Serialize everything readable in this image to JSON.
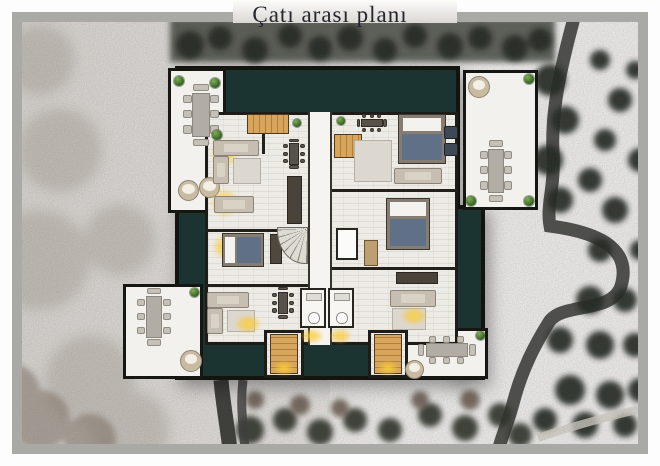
{
  "title": "Çatı arası planı",
  "colors": {
    "frame": "#a9a9a5",
    "wall": "#14140f",
    "roof": "#1b3331",
    "terrace": "#f2f1ed",
    "floor": "#edebe5",
    "hall": "#f5f4f0",
    "wood": "#d7a55c",
    "wood_dark": "#b07f3f",
    "glow": "#f6cf3a",
    "blanket": "#5f7087",
    "sofa": "#c6bfb1",
    "table_gray": "#b2ada4",
    "chair_gray": "#c6c1b8",
    "table_dark": "#57534b",
    "plant": "#3e6b2a",
    "road": "#3c3c3a",
    "snow": "#f2f1ef",
    "trees": "#22261f"
  },
  "plan": {
    "regions": [
      {
        "name": "roof-main",
        "type": "roof",
        "x": 175,
        "y": 66,
        "w": 285,
        "h": 314
      },
      {
        "name": "roof-right-wing",
        "type": "roof",
        "x": 452,
        "y": 205,
        "w": 33,
        "h": 175
      },
      {
        "name": "terrace-top-left",
        "type": "terrace",
        "x": 168,
        "y": 68,
        "w": 58,
        "h": 145
      },
      {
        "name": "terrace-top-right",
        "type": "terrace",
        "x": 463,
        "y": 70,
        "w": 75,
        "h": 140
      },
      {
        "name": "terrace-bottom-left",
        "type": "terrace",
        "x": 123,
        "y": 284,
        "w": 80,
        "h": 95
      },
      {
        "name": "terrace-bottom-right",
        "type": "terrace",
        "x": 403,
        "y": 328,
        "w": 85,
        "h": 51
      },
      {
        "name": "apartments-interior",
        "type": "floor",
        "x": 205,
        "y": 112,
        "w": 253,
        "h": 233
      },
      {
        "name": "stairwell-south-left",
        "type": "floor",
        "x": 264,
        "y": 330,
        "w": 40,
        "h": 48
      },
      {
        "name": "stairwell-south-right",
        "type": "floor",
        "x": 368,
        "y": 330,
        "w": 40,
        "h": 48
      },
      {
        "name": "central-corridor",
        "type": "hall",
        "x": 308,
        "y": 112,
        "w": 24,
        "h": 233
      },
      {
        "name": "elevator",
        "type": "lift",
        "x": 336,
        "y": 228,
        "w": 22,
        "h": 32
      },
      {
        "name": "bathroom",
        "type": "bath",
        "x": 300,
        "y": 288,
        "w": 26,
        "h": 40
      },
      {
        "name": "bathroom",
        "type": "bath",
        "x": 328,
        "y": 288,
        "w": 26,
        "h": 40
      }
    ],
    "walls": [
      {
        "x": 205,
        "y": 229,
        "w": 103,
        "h": 3
      },
      {
        "x": 332,
        "y": 189,
        "w": 126,
        "h": 3
      },
      {
        "x": 205,
        "y": 284,
        "w": 103,
        "h": 3
      },
      {
        "x": 332,
        "y": 267,
        "w": 126,
        "h": 3
      },
      {
        "x": 262,
        "y": 112,
        "w": 3,
        "h": 42
      }
    ],
    "furniture": [
      {
        "type": "dining-v",
        "name": "terrace-tl-dining-table",
        "x": 183,
        "y": 86,
        "w": 36,
        "h": 58
      },
      {
        "type": "plant",
        "name": "plant",
        "x": 174,
        "y": 76,
        "w": 10,
        "h": 10
      },
      {
        "type": "plant",
        "name": "plant",
        "x": 210,
        "y": 78,
        "w": 10,
        "h": 10
      },
      {
        "type": "plant",
        "name": "plant",
        "x": 212,
        "y": 130,
        "w": 10,
        "h": 10
      },
      {
        "type": "lounger",
        "name": "lounge-chair",
        "x": 178,
        "y": 180,
        "w": 21,
        "h": 21
      },
      {
        "type": "lounger",
        "name": "lounge-chair",
        "x": 199,
        "y": 177,
        "w": 21,
        "h": 21
      },
      {
        "type": "lounger",
        "name": "lounge-chair",
        "x": 468,
        "y": 76,
        "w": 22,
        "h": 22
      },
      {
        "type": "dining-v",
        "name": "terrace-tr-dining-table",
        "x": 480,
        "y": 142,
        "w": 32,
        "h": 58
      },
      {
        "type": "plant",
        "name": "plant",
        "x": 524,
        "y": 74,
        "w": 10,
        "h": 10
      },
      {
        "type": "plant",
        "name": "plant",
        "x": 466,
        "y": 196,
        "w": 10,
        "h": 10
      },
      {
        "type": "plant",
        "name": "plant",
        "x": 524,
        "y": 196,
        "w": 10,
        "h": 10
      },
      {
        "type": "dining-v",
        "name": "terrace-bl-dining-table",
        "x": 137,
        "y": 290,
        "w": 34,
        "h": 54
      },
      {
        "type": "plant",
        "name": "plant",
        "x": 190,
        "y": 288,
        "w": 9,
        "h": 9
      },
      {
        "type": "lounger",
        "name": "lounge-chair",
        "x": 180,
        "y": 350,
        "w": 22,
        "h": 22
      },
      {
        "type": "dining-h",
        "name": "terrace-br-dining-table",
        "x": 420,
        "y": 336,
        "w": 54,
        "h": 28
      },
      {
        "type": "plant",
        "name": "plant",
        "x": 476,
        "y": 331,
        "w": 9,
        "h": 9
      },
      {
        "type": "lounger",
        "name": "lounge-chair",
        "x": 405,
        "y": 360,
        "w": 19,
        "h": 19
      },
      {
        "type": "stairs-h",
        "name": "stairs",
        "x": 247,
        "y": 114,
        "w": 42,
        "h": 20
      },
      {
        "type": "plant",
        "name": "plant",
        "x": 293,
        "y": 119,
        "w": 8,
        "h": 8
      },
      {
        "type": "glow",
        "name": "lamp-glow",
        "x": 210,
        "y": 138,
        "w": 30,
        "h": 30
      },
      {
        "type": "sofa-h",
        "name": "sofa",
        "x": 213,
        "y": 140,
        "w": 46,
        "h": 16
      },
      {
        "type": "sofa-v",
        "name": "sofa",
        "x": 213,
        "y": 156,
        "w": 16,
        "h": 28
      },
      {
        "type": "rug",
        "name": "rug",
        "x": 233,
        "y": 158,
        "w": 28,
        "h": 26
      },
      {
        "type": "dining-dark-v",
        "name": "dining-table",
        "x": 283,
        "y": 140,
        "w": 22,
        "h": 28
      },
      {
        "type": "counter",
        "name": "kitchen-counter",
        "x": 287,
        "y": 176,
        "w": 15,
        "h": 48
      },
      {
        "type": "glow",
        "name": "lamp-glow",
        "x": 210,
        "y": 188,
        "w": 30,
        "h": 30
      },
      {
        "type": "sofa-h",
        "name": "sofa",
        "x": 214,
        "y": 196,
        "w": 40,
        "h": 17
      },
      {
        "type": "stairs-h",
        "name": "stairs",
        "x": 334,
        "y": 134,
        "w": 28,
        "h": 24
      },
      {
        "type": "plant",
        "name": "plant",
        "x": 337,
        "y": 117,
        "w": 8,
        "h": 8
      },
      {
        "type": "dining-dark-h",
        "name": "dining-table",
        "x": 358,
        "y": 114,
        "w": 28,
        "h": 18
      },
      {
        "type": "rug",
        "name": "rug",
        "x": 354,
        "y": 140,
        "w": 38,
        "h": 42
      },
      {
        "type": "bed-v",
        "name": "bed",
        "x": 398,
        "y": 114,
        "w": 48,
        "h": 50
      },
      {
        "type": "chair-dark",
        "name": "armchair",
        "x": 444,
        "y": 126,
        "w": 14,
        "h": 13
      },
      {
        "type": "chair-dark",
        "name": "armchair",
        "x": 444,
        "y": 143,
        "w": 14,
        "h": 13
      },
      {
        "type": "sofa-h",
        "name": "sofa",
        "x": 394,
        "y": 168,
        "w": 48,
        "h": 16
      },
      {
        "type": "glow",
        "name": "lamp-glow",
        "x": 212,
        "y": 234,
        "w": 26,
        "h": 26
      },
      {
        "type": "bed-h",
        "name": "bed",
        "x": 222,
        "y": 233,
        "w": 42,
        "h": 34
      },
      {
        "type": "dresser",
        "name": "wardrobe",
        "x": 270,
        "y": 234,
        "w": 12,
        "h": 30
      },
      {
        "type": "bed-v",
        "name": "bed",
        "x": 386,
        "y": 198,
        "w": 44,
        "h": 52
      },
      {
        "type": "desk",
        "name": "desk",
        "x": 364,
        "y": 240,
        "w": 14,
        "h": 26
      },
      {
        "type": "winder",
        "name": "winder-stair",
        "x": 277,
        "y": 227,
        "w": 31,
        "h": 37
      },
      {
        "type": "sofa-h",
        "name": "sofa",
        "x": 207,
        "y": 292,
        "w": 42,
        "h": 16
      },
      {
        "type": "sofa-v",
        "name": "sofa",
        "x": 207,
        "y": 308,
        "w": 16,
        "h": 26
      },
      {
        "type": "rug",
        "name": "rug",
        "x": 227,
        "y": 310,
        "w": 28,
        "h": 22
      },
      {
        "type": "glow",
        "name": "lamp-glow",
        "x": 234,
        "y": 314,
        "w": 28,
        "h": 20
      },
      {
        "type": "dining-dark-v",
        "name": "dining-table",
        "x": 272,
        "y": 288,
        "w": 22,
        "h": 30
      },
      {
        "type": "counter",
        "name": "kitchen-counter",
        "x": 396,
        "y": 272,
        "w": 42,
        "h": 12
      },
      {
        "type": "sofa-h",
        "name": "sofa",
        "x": 390,
        "y": 290,
        "w": 46,
        "h": 17
      },
      {
        "type": "rug",
        "name": "rug",
        "x": 392,
        "y": 308,
        "w": 34,
        "h": 22
      },
      {
        "type": "glow",
        "name": "lamp-glow",
        "x": 400,
        "y": 306,
        "w": 28,
        "h": 20
      },
      {
        "type": "stairs-v",
        "name": "stairs",
        "x": 270,
        "y": 334,
        "w": 28,
        "h": 40
      },
      {
        "type": "stairs-v",
        "name": "stairs",
        "x": 374,
        "y": 334,
        "w": 28,
        "h": 40
      },
      {
        "type": "glow",
        "name": "lamp-glow",
        "x": 272,
        "y": 360,
        "w": 24,
        "h": 16
      },
      {
        "type": "glow",
        "name": "lamp-glow",
        "x": 376,
        "y": 360,
        "w": 24,
        "h": 16
      },
      {
        "type": "glow",
        "name": "lamp-glow",
        "x": 300,
        "y": 328,
        "w": 24,
        "h": 16
      },
      {
        "type": "glow",
        "name": "lamp-glow",
        "x": 328,
        "y": 328,
        "w": 24,
        "h": 16
      }
    ]
  }
}
